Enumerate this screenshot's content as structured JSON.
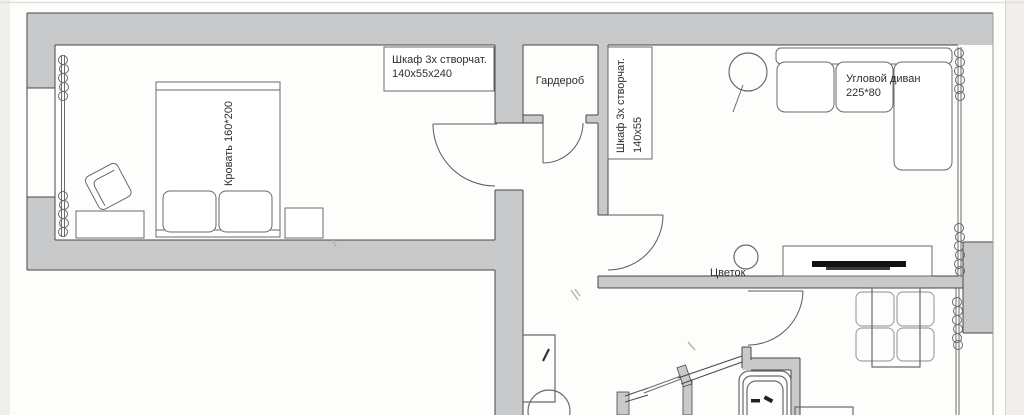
{
  "plan": {
    "title_note": "apartment floor plan",
    "labels": {
      "wardrobe_top_line1": "Шкаф 3х створчат.",
      "wardrobe_top_line2": "140х55х240",
      "garderob": "Гардероб",
      "wardrobe_side_line1": "Шкаф 3х створчат.",
      "wardrobe_side_line2": "140х55",
      "bed": "Кровать 160*200",
      "sofa_line1": "Угловой диван",
      "sofa_line2": "225*80",
      "flower": "Цветок"
    },
    "colors": {
      "wall_fill": "#c8c9ca",
      "outline": "#474747",
      "furniture_line": "#6a6a6a",
      "background": "#fdfdfc",
      "margin": "#f1efec",
      "tv_black": "#111111"
    }
  }
}
